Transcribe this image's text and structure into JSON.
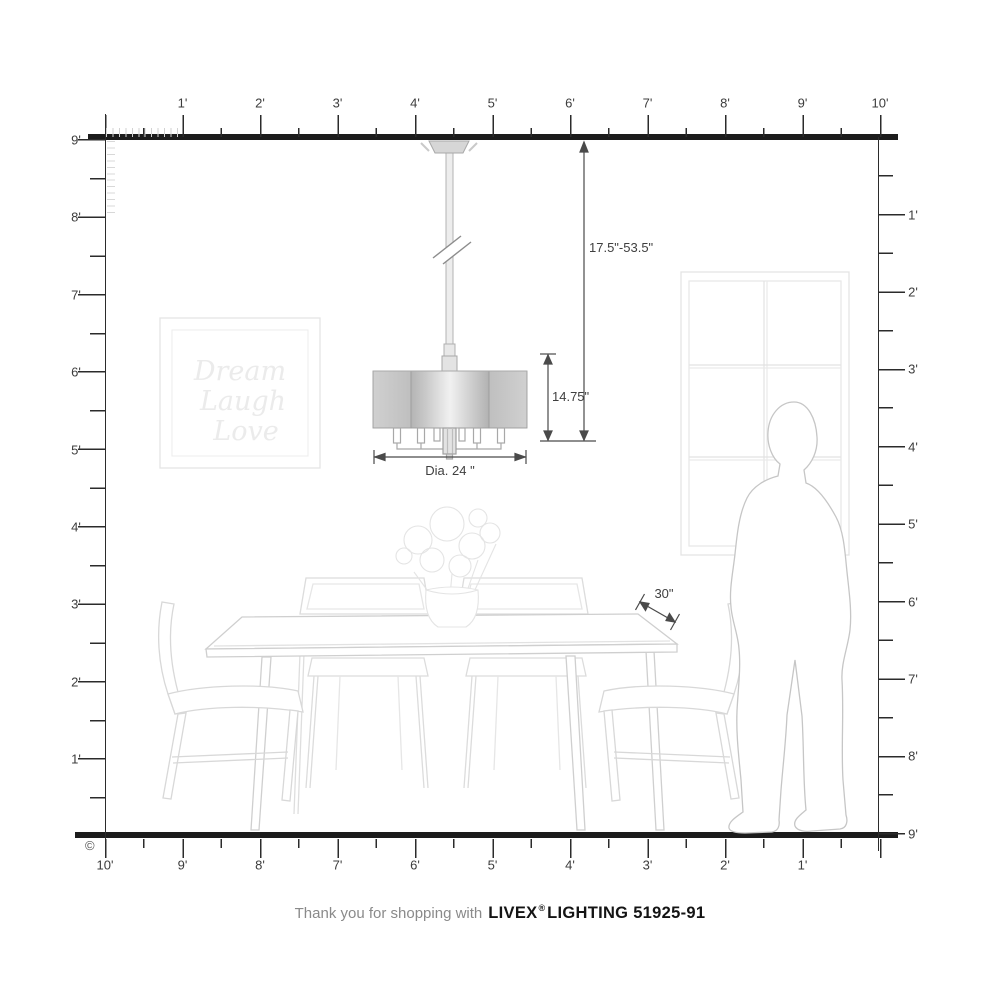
{
  "rulers": {
    "top": {
      "labels": [
        "1'",
        "2'",
        "3'",
        "4'",
        "5'",
        "6'",
        "7'",
        "8'",
        "9'",
        "10'"
      ]
    },
    "left": {
      "labels": [
        "9'",
        "8'",
        "7'",
        "6'",
        "5'",
        "4'",
        "3'",
        "2'",
        "1'"
      ]
    },
    "right": {
      "labels": [
        "1'",
        "2'",
        "3'",
        "4'",
        "5'",
        "6'",
        "7'",
        "8'",
        "9'"
      ]
    },
    "bottom": {
      "labels": [
        "10'",
        "9'",
        "8'",
        "7'",
        "6'",
        "5'",
        "4'",
        "3'",
        "2'",
        "1'"
      ]
    }
  },
  "dimensions": {
    "hanging_height_label": "17.5\"-53.5\"",
    "fixture_height_label": "14.75\"",
    "diameter_label": "Dia. 24 \"",
    "table_edge_label": "30\""
  },
  "wall_art": {
    "line1": "Dream",
    "line2": "Laugh",
    "line3": "Love"
  },
  "footer": {
    "prefix": "Thank you for shopping with",
    "brand": "LIVEX",
    "registered_mark": "®",
    "suffix": "LIGHTING 51925-91"
  },
  "copyright_mark": "©",
  "colors": {
    "structure": "#1c1c1c",
    "dimension_lines": "#4a4a4a",
    "furniture_sketch": "#d4d4d4",
    "person_outline": "#c6c6c6",
    "window_sketch": "#e2e2e2",
    "shade_dark": "#b4b4b4",
    "shade_light": "#f1f1f1"
  }
}
